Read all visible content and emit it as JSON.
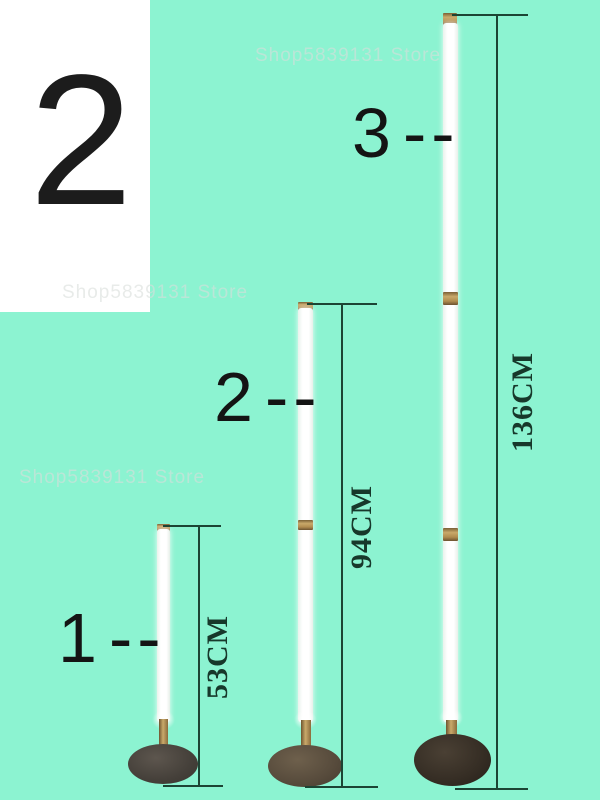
{
  "background_color": "#8cf3d1",
  "variant_badge": {
    "value": "2"
  },
  "watermarks": [
    {
      "text": "Shop5839131 Store"
    },
    {
      "text": "Shop5839131 Store"
    },
    {
      "text": "Shop5839131 Store"
    }
  ],
  "lamps": [
    {
      "number": "1",
      "dashes": "--",
      "height": "53CM"
    },
    {
      "number": "2",
      "dashes": "--",
      "height": "94CM"
    },
    {
      "number": "3",
      "dashes": "--",
      "height": "136CM"
    }
  ],
  "colors": {
    "background": "#8cf3d1",
    "dimension_line": "#1c4434",
    "dimension_text": "#17382b",
    "label_text": "#141414",
    "gold_fitting": "#b8965a",
    "tube": "#ffffff",
    "base_dark": "#3a332b"
  }
}
